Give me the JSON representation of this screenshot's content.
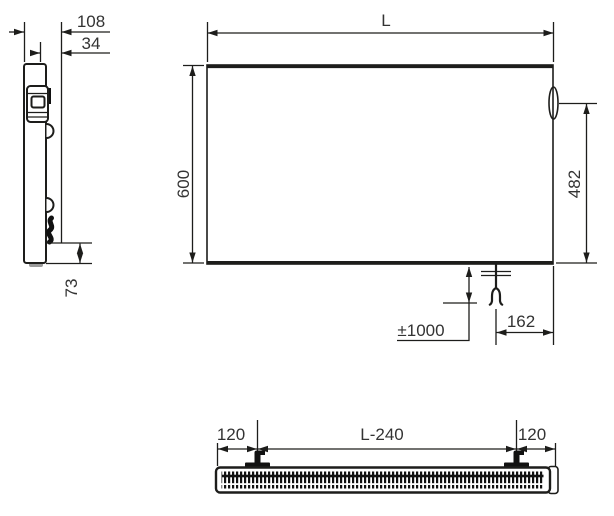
{
  "style": {
    "line_color": "#1d1d1b",
    "text_color": "#333333",
    "background": "#ffffff"
  },
  "views": {
    "side": {
      "labels": {
        "depth_total": "108",
        "depth_inner": "34",
        "bottom_offset": "73"
      }
    },
    "front": {
      "labels": {
        "length": "L",
        "height": "600",
        "right_height": "482",
        "cable_length": "±1000",
        "cable_inset": "162"
      }
    },
    "bottom": {
      "labels": {
        "left_margin": "120",
        "center_span": "L-240",
        "right_margin": "120"
      }
    }
  }
}
